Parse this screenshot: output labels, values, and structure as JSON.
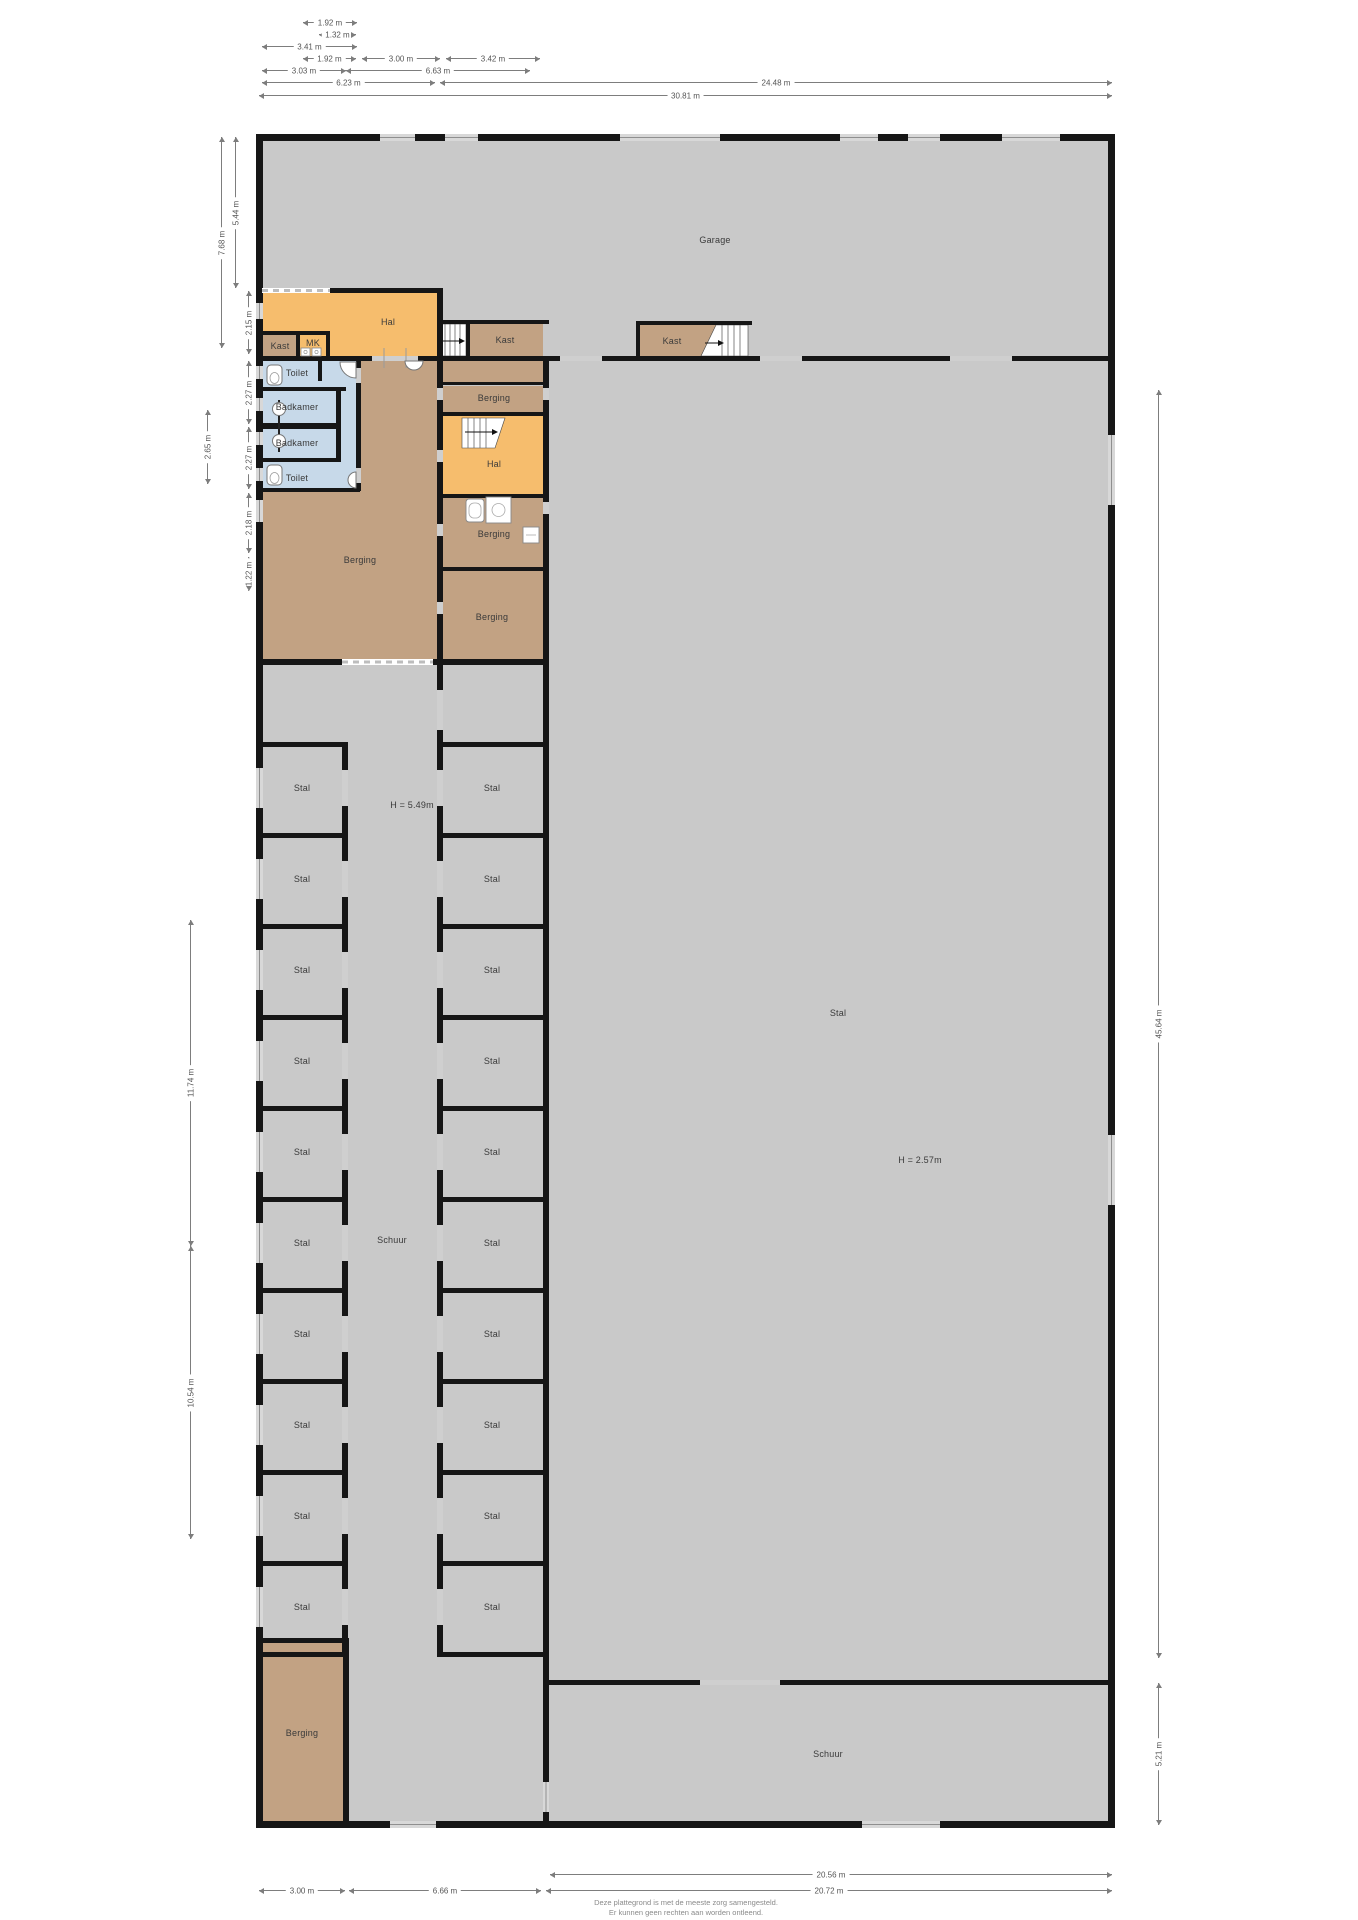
{
  "colors": {
    "floor_gray": "#c9c9c9",
    "room_orange": "#f6bd6d",
    "room_tan": "#c2a283",
    "room_blue": "#c7d9e9",
    "wall": "#161616",
    "window_gap": "#d8d8d8",
    "door_gap": "#cfcfcf"
  },
  "rooms": [
    {
      "label": "Garage",
      "x": 715,
      "y": 240
    },
    {
      "label": "Hal",
      "x": 388,
      "y": 322
    },
    {
      "label": "Kast",
      "x": 280,
      "y": 346
    },
    {
      "label": "MK",
      "x": 313,
      "y": 343
    },
    {
      "label": "Toilet",
      "x": 297,
      "y": 373
    },
    {
      "label": "Badkamer",
      "x": 297,
      "y": 407
    },
    {
      "label": "Badkamer",
      "x": 297,
      "y": 443
    },
    {
      "label": "Toilet",
      "x": 297,
      "y": 478
    },
    {
      "label": "Berging",
      "x": 360,
      "y": 560
    },
    {
      "label": "Kast",
      "x": 505,
      "y": 340
    },
    {
      "label": "Berging",
      "x": 494,
      "y": 398
    },
    {
      "label": "Hal",
      "x": 494,
      "y": 464
    },
    {
      "label": "Berging",
      "x": 494,
      "y": 534
    },
    {
      "label": "Berging",
      "x": 492,
      "y": 617
    },
    {
      "label": "Kast",
      "x": 672,
      "y": 341
    },
    {
      "label": "Schuur",
      "x": 392,
      "y": 1240
    },
    {
      "label": "H = 5.49m",
      "x": 412,
      "y": 805
    },
    {
      "label": "Stal",
      "x": 838,
      "y": 1013
    },
    {
      "label": "H = 2.57m",
      "x": 920,
      "y": 1160
    },
    {
      "label": "Stal",
      "x": 302,
      "y": 788
    },
    {
      "label": "Stal",
      "x": 302,
      "y": 879
    },
    {
      "label": "Stal",
      "x": 302,
      "y": 970
    },
    {
      "label": "Stal",
      "x": 302,
      "y": 1061
    },
    {
      "label": "Stal",
      "x": 302,
      "y": 1152
    },
    {
      "label": "Stal",
      "x": 302,
      "y": 1243
    },
    {
      "label": "Stal",
      "x": 302,
      "y": 1334
    },
    {
      "label": "Stal",
      "x": 302,
      "y": 1425
    },
    {
      "label": "Stal",
      "x": 302,
      "y": 1516
    },
    {
      "label": "Stal",
      "x": 302,
      "y": 1607
    },
    {
      "label": "Stal",
      "x": 492,
      "y": 788
    },
    {
      "label": "Stal",
      "x": 492,
      "y": 879
    },
    {
      "label": "Stal",
      "x": 492,
      "y": 970
    },
    {
      "label": "Stal",
      "x": 492,
      "y": 1061
    },
    {
      "label": "Stal",
      "x": 492,
      "y": 1152
    },
    {
      "label": "Stal",
      "x": 492,
      "y": 1243
    },
    {
      "label": "Stal",
      "x": 492,
      "y": 1334
    },
    {
      "label": "Stal",
      "x": 492,
      "y": 1425
    },
    {
      "label": "Stal",
      "x": 492,
      "y": 1516
    },
    {
      "label": "Stal",
      "x": 492,
      "y": 1607
    },
    {
      "label": "Berging",
      "x": 302,
      "y": 1733
    },
    {
      "label": "Schuur",
      "x": 828,
      "y": 1754
    }
  ],
  "dimensions": {
    "top": [
      {
        "y": 22,
        "x1": 303,
        "x2": 357,
        "label": "1.92 m"
      },
      {
        "y": 34,
        "x1": 319,
        "x2": 356,
        "label": "1.32 m"
      },
      {
        "y": 46,
        "x1": 262,
        "x2": 357,
        "label": "3.41 m"
      },
      {
        "y": 58,
        "x1": 303,
        "x2": 356,
        "label": "1.92 m"
      },
      {
        "y": 58,
        "x1": 362,
        "x2": 440,
        "label": "3.00 m"
      },
      {
        "y": 58,
        "x1": 446,
        "x2": 540,
        "label": "3.42 m"
      },
      {
        "y": 70,
        "x1": 262,
        "x2": 346,
        "label": "3.03 m"
      },
      {
        "y": 70,
        "x1": 346,
        "x2": 530,
        "label": "6.63 m"
      },
      {
        "y": 82,
        "x1": 262,
        "x2": 435,
        "label": "6.23 m"
      },
      {
        "y": 82,
        "x1": 440,
        "x2": 1112,
        "label": "24.48 m"
      },
      {
        "y": 95,
        "x1": 259,
        "x2": 1112,
        "label": "30.81 m"
      }
    ],
    "left": [
      {
        "x": 221,
        "y1": 137,
        "y2": 348,
        "label": "7.68 m"
      },
      {
        "x": 235,
        "y1": 137,
        "y2": 288,
        "label": "5.44 m"
      },
      {
        "x": 248,
        "y1": 291,
        "y2": 354,
        "label": "2.15 m"
      },
      {
        "x": 248,
        "y1": 361,
        "y2": 424,
        "label": "2.27 m"
      },
      {
        "x": 248,
        "y1": 427,
        "y2": 489,
        "label": "2.27 m"
      },
      {
        "x": 248,
        "y1": 493,
        "y2": 553,
        "label": "2.18 m"
      },
      {
        "x": 248,
        "y1": 557,
        "y2": 591,
        "label": "1.22 m"
      },
      {
        "x": 207,
        "y1": 410,
        "y2": 484,
        "label": "2.65 m"
      },
      {
        "x": 190,
        "y1": 920,
        "y2": 1246,
        "label": "11.74 m"
      },
      {
        "x": 190,
        "y1": 1246,
        "y2": 1539,
        "label": "10.54 m"
      }
    ],
    "right": [
      {
        "x": 1158,
        "y1": 390,
        "y2": 1658,
        "label": "45.64 m"
      },
      {
        "x": 1158,
        "y1": 1683,
        "y2": 1825,
        "label": "5.21 m"
      }
    ],
    "bottom": [
      {
        "y": 1874,
        "x1": 550,
        "x2": 1112,
        "label": "20.56 m"
      },
      {
        "y": 1890,
        "x1": 259,
        "x2": 345,
        "label": "3.00 m"
      },
      {
        "y": 1890,
        "x1": 349,
        "x2": 541,
        "label": "6.66 m"
      },
      {
        "y": 1890,
        "x1": 546,
        "x2": 1112,
        "label": "20.72 m"
      }
    ]
  },
  "disclaimer": {
    "line1": "Deze plattegrond is met de meeste zorg samengesteld.",
    "line2": "Er kunnen geen rechten aan worden ontleend."
  }
}
